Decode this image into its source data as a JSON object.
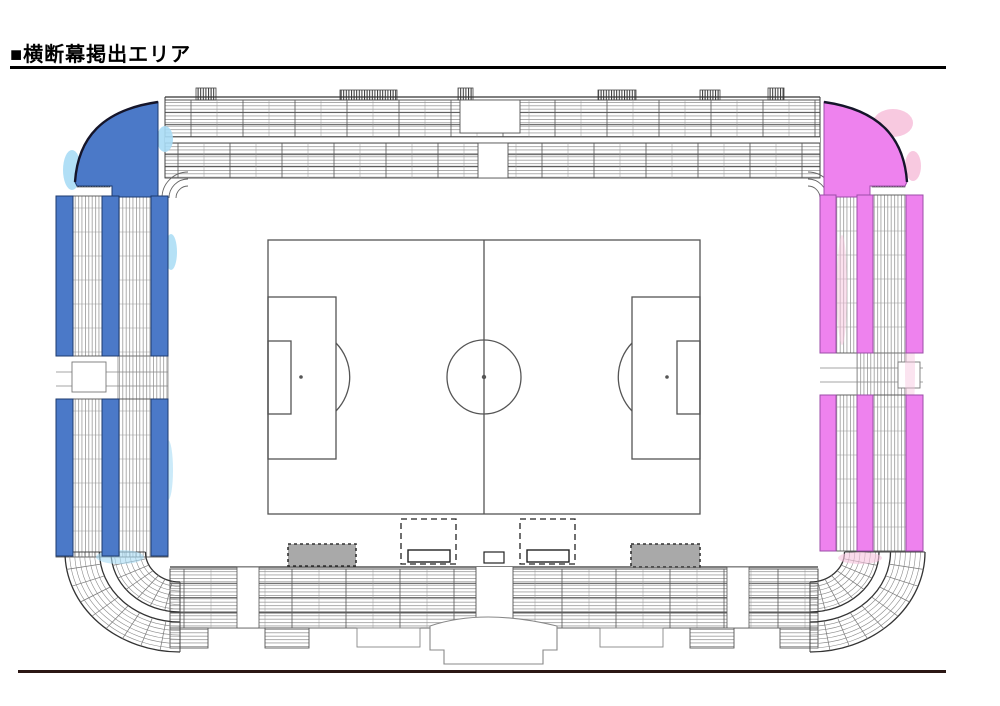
{
  "title": "■横断幕掲出エリア",
  "colors": {
    "banner_blue": "#4b79c8",
    "banner_blue_outline": "#1d3a6e",
    "banner_blue_halo": "#a8dcf5",
    "banner_pink": "#ee82ee",
    "banner_pink_outline": "#9c4da8",
    "banner_pink_halo": "#f7c3dd",
    "gray_box": "#a9a9a9",
    "seat_line": "#8a8a8a",
    "structure_line": "#444444",
    "light_line": "#999999",
    "field_line": "#555555",
    "title_rule": "#000000",
    "footer_rule": "#2b1714"
  },
  "banner_zones": [
    {
      "side": "left",
      "color_key": "banner_blue",
      "corner_wedges": 1,
      "bars": 6
    },
    {
      "side": "right",
      "color_key": "banner_pink",
      "corner_wedges": 1,
      "bars": 6
    }
  ]
}
